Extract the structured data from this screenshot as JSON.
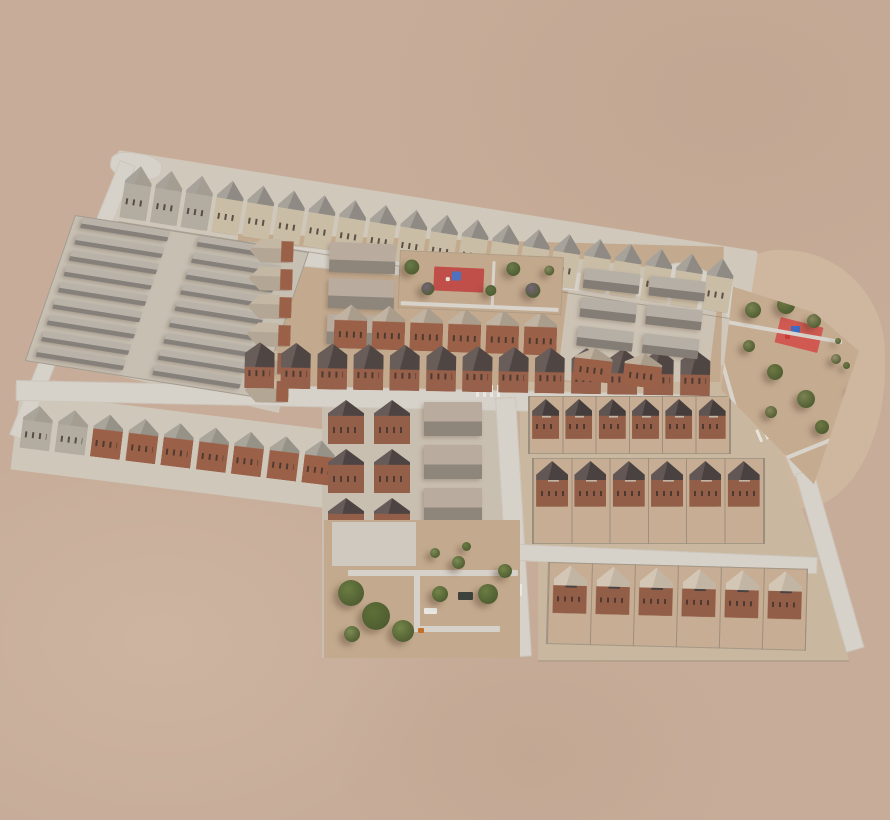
{
  "scene": {
    "type": "aerial-3d-render",
    "subject": "isometric aerial rendering of a desert residential development master plan with house rows, parks, playgrounds and roads",
    "background_color": "#c7ad99",
    "total_parks": 3,
    "playground_pads": 2
  },
  "palette": {
    "desert": "#c7ad99",
    "pavement": "#d0c8bb",
    "road": "#d7d2c9",
    "dirt": "#c3aa8e",
    "roof_gray": "#908c85",
    "roof_gray_light": "#a7a29a",
    "roof_tan": "#ab9d8c",
    "roof_tan_light": "#c1b3a1",
    "roof_dark": "#4b4240",
    "roof_dark_light": "#645856",
    "roof_cream": "#c3b5a3",
    "wall_brick": "#9a6148",
    "wall_cream": "#cabda6",
    "wall_gray": "#b3aca0",
    "unit_top": "#b7b1a8",
    "unit_side": "#837d75",
    "slab_top": "#b9ac9e",
    "slab_side": "#8e857b",
    "pad_red": "#c4544c",
    "equip_blue": "#4a72c4",
    "tree_green": "#6a7a4a",
    "tree_purple": "#77657a"
  },
  "groups": {
    "topRow": {
      "count": 20,
      "w": 27,
      "h": 54,
      "gap": 4,
      "roof": "#8f8b84",
      "roofLight": "#a7a29a",
      "wall": "#cabda6",
      "grayFirst": 3,
      "grayWall": "#b3aca0",
      "grayRoof": "#a39d92"
    },
    "colA": {
      "count": 6,
      "w": 44,
      "h": 24,
      "gapY": 4,
      "roof": "#b3a694",
      "roofLight": "#c4b7a4",
      "wall": "#9a6148",
      "side": true
    },
    "colSlabs": {
      "count": 3,
      "w": 66,
      "h": 30,
      "gapY": 6,
      "top": "#b9ac9e",
      "side": "#8e857b"
    },
    "rowB": {
      "count": 6,
      "w": 33,
      "h": 44,
      "gap": 5,
      "roof": "#ab9d8c",
      "roofLight": "#c1b3a1",
      "wall": "#9a6148"
    },
    "rowC": {
      "count": 13,
      "w": 30,
      "h": 46,
      "gap": 6.3,
      "roof": "#4f4543",
      "roofLight": "#695d5a",
      "wall": "#96604a",
      "front": true
    },
    "rowH": {
      "count": 9,
      "w": 30,
      "h": 44,
      "gap": 5.5,
      "roof": "#979288",
      "roofLight": "#aaa59b",
      "wall": "#9a6148",
      "grayFirst": 2,
      "grayWall": "#b3aca0",
      "grayRoof": "#a39d92"
    },
    "leftBlock": {
      "cols": 2,
      "rows": 9,
      "w": 88,
      "h": 11,
      "gapY": 5.8,
      "colX": [
        8,
        126
      ],
      "top": "#b8b2a9",
      "side": "#85807a"
    },
    "blockEflats": {
      "cols": 2,
      "rows": 3,
      "w": 56,
      "h": 20,
      "gapX": 10,
      "gapY": 9,
      "top": "#b5afa6",
      "side": "#837d75"
    },
    "blockEhouses": {
      "count": 2,
      "w": 38,
      "h": 34,
      "gap": 12,
      "roof": "#aa9c8b",
      "roofLight": "#bfb19e",
      "wall": "#9a6148"
    },
    "clusterG": {
      "count": 6,
      "cols": 2,
      "w": 36,
      "h": 44,
      "gapX": 10,
      "gapY": 5,
      "roof": "#4c4342",
      "roofLight": "#665b58",
      "wall": "#945f48"
    },
    "clusterS": {
      "count": 3,
      "w": 58,
      "h": 34,
      "gapY": 9,
      "top": "#b9ac9e",
      "side": "#8e857b"
    },
    "lRow1": {
      "count": 6,
      "w": 27,
      "h": 40,
      "lot": 33.3,
      "roof": "#453d3c",
      "roofLight": "#5e5452",
      "wall": "#935e47",
      "acc": "#c3b5a3",
      "duo": true
    },
    "lRow2": {
      "count": 6,
      "w": 32,
      "h": 46,
      "lot": 38.3,
      "roof": "#4a4240",
      "roofLight": "#635755",
      "wall": "#935e47",
      "acc": "#c3b5a3",
      "duo": true
    },
    "lRow3": {
      "count": 6,
      "w": 34,
      "h": 48,
      "lot": 43,
      "roof": "#c3b5a3",
      "roofLight": "#d3c6b4",
      "wall": "#935e47",
      "acc": "#4a4240",
      "duo": true
    }
  },
  "parks": {
    "top": {
      "treePalette": [
        "#6a7a4a",
        "#5f7044",
        "#77657a",
        "#8a8a60"
      ],
      "trees": [
        [
          4,
          8,
          15,
          0
        ],
        [
          22,
          30,
          13,
          2
        ],
        [
          86,
          30,
          11,
          1
        ],
        [
          106,
          6,
          14,
          0
        ],
        [
          126,
          26,
          15,
          2
        ],
        [
          144,
          8,
          10,
          3
        ]
      ],
      "rects": [
        {
          "x": 34,
          "y": 14,
          "w": 50,
          "h": 24,
          "c": "#bf4f48",
          "name": "playground-pad"
        },
        {
          "x": 52,
          "y": 18,
          "w": 9,
          "h": 9,
          "c": "#4e72c0",
          "name": "play-structure"
        },
        {
          "x": 46,
          "y": 24,
          "w": 4,
          "h": 4,
          "c": "#e8e4da",
          "name": "play-structure"
        },
        {
          "x": 2,
          "y": 50,
          "w": 158,
          "h": 4,
          "c": "#d8d3cb",
          "name": "path"
        },
        {
          "x": 92,
          "y": 6,
          "w": 3,
          "h": 46,
          "c": "#d8d3cb",
          "name": "path"
        }
      ]
    },
    "k": {
      "treePalette": [
        "#5e7038",
        "#6b7c42",
        "#748549",
        "#7d8b55"
      ],
      "trees": [
        [
          14,
          60,
          26,
          1
        ],
        [
          38,
          82,
          28,
          0
        ],
        [
          68,
          100,
          22,
          2
        ],
        [
          20,
          106,
          16,
          3
        ],
        [
          108,
          66,
          16,
          2
        ],
        [
          128,
          36,
          13,
          3
        ],
        [
          154,
          64,
          20,
          1
        ],
        [
          174,
          44,
          14,
          2
        ],
        [
          106,
          28,
          10,
          3
        ],
        [
          138,
          22,
          9,
          1
        ]
      ],
      "rects": [
        {
          "x": 8,
          "y": 2,
          "w": 84,
          "h": 44,
          "c": "#cfc9c0",
          "name": "parking-pad"
        },
        {
          "x": 24,
          "y": 50,
          "w": 170,
          "h": 6,
          "c": "#d6d1c9",
          "name": "path"
        },
        {
          "x": 90,
          "y": 50,
          "w": 6,
          "h": 62,
          "c": "#d6d1c9",
          "name": "path"
        },
        {
          "x": 90,
          "y": 106,
          "w": 86,
          "h": 6,
          "c": "#d6d1c9",
          "name": "path"
        },
        {
          "x": 134,
          "y": 72,
          "w": 15,
          "h": 8,
          "c": "#3d423d",
          "name": "van"
        },
        {
          "x": 100,
          "y": 88,
          "w": 13,
          "h": 6,
          "c": "#e9e7e2",
          "name": "car"
        },
        {
          "x": 94,
          "y": 108,
          "w": 6,
          "h": 5,
          "c": "#c2702a",
          "name": "play-structure"
        }
      ]
    },
    "r": {
      "treePalette": [
        "#7b8252",
        "#6d7844",
        "#87885c",
        "#9a9170"
      ],
      "trees": [
        [
          30,
          24,
          16,
          0
        ],
        [
          62,
          18,
          18,
          1
        ],
        [
          92,
          36,
          14,
          2
        ],
        [
          28,
          62,
          12,
          0
        ],
        [
          52,
          86,
          16,
          1
        ],
        [
          82,
          112,
          18,
          0
        ],
        [
          50,
          128,
          12,
          2
        ],
        [
          100,
          142,
          14,
          1
        ],
        [
          116,
          76,
          10,
          3
        ],
        [
          120,
          60,
          6,
          0
        ],
        [
          128,
          84,
          7,
          1
        ],
        [
          134,
          108,
          6,
          0
        ],
        [
          136,
          132,
          7,
          1
        ],
        [
          130,
          156,
          6,
          0
        ],
        [
          120,
          176,
          7,
          1
        ]
      ],
      "rects": [
        {
          "x": 62,
          "y": 44,
          "w": 44,
          "h": 26,
          "c": "#d05a52",
          "rot": 14,
          "name": "playground-pad"
        },
        {
          "x": 76,
          "y": 48,
          "w": 9,
          "h": 9,
          "c": "#3f6bc1",
          "name": "play-structure"
        },
        {
          "x": 70,
          "y": 56,
          "w": 5,
          "h": 5,
          "c": "#c93b35",
          "name": "play-structure"
        },
        {
          "x": 10,
          "y": 52,
          "w": 118,
          "h": 4,
          "c": "#d8d3cb",
          "rot": 10,
          "name": "path"
        },
        {
          "x": 16,
          "y": 58,
          "w": 4,
          "h": 128,
          "c": "#d8d3cb",
          "rot": -16,
          "name": "path"
        },
        {
          "x": 22,
          "y": 176,
          "w": 108,
          "h": 4,
          "c": "#d8d3cb",
          "rot": -22,
          "name": "path"
        }
      ]
    }
  }
}
